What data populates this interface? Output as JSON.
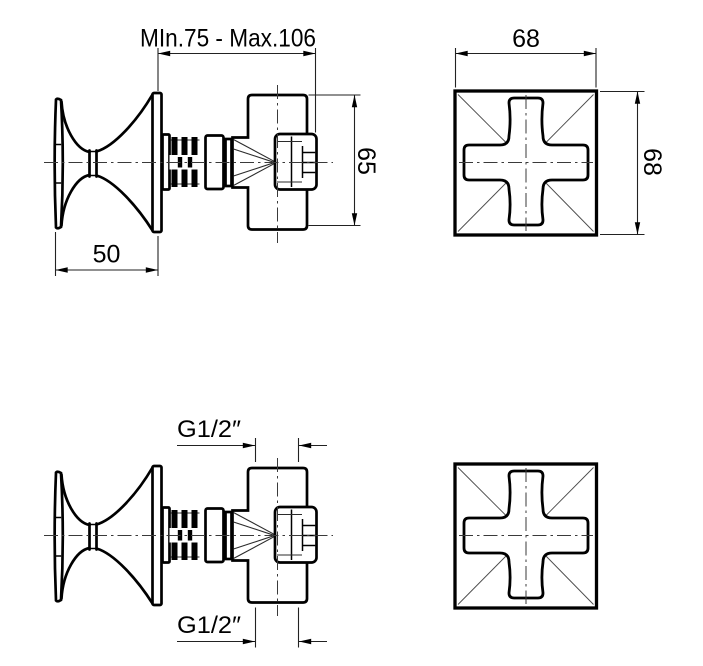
{
  "colors": {
    "background": "#ffffff",
    "lines": "#000000"
  },
  "dimensions": {
    "depth_range": "MIn.75 - Max.106",
    "knob_width": "50",
    "body_height": "65",
    "plate_width": "68",
    "plate_height": "68",
    "inlet_thread": "G1/2″",
    "outlet_thread": "G1/2″"
  }
}
